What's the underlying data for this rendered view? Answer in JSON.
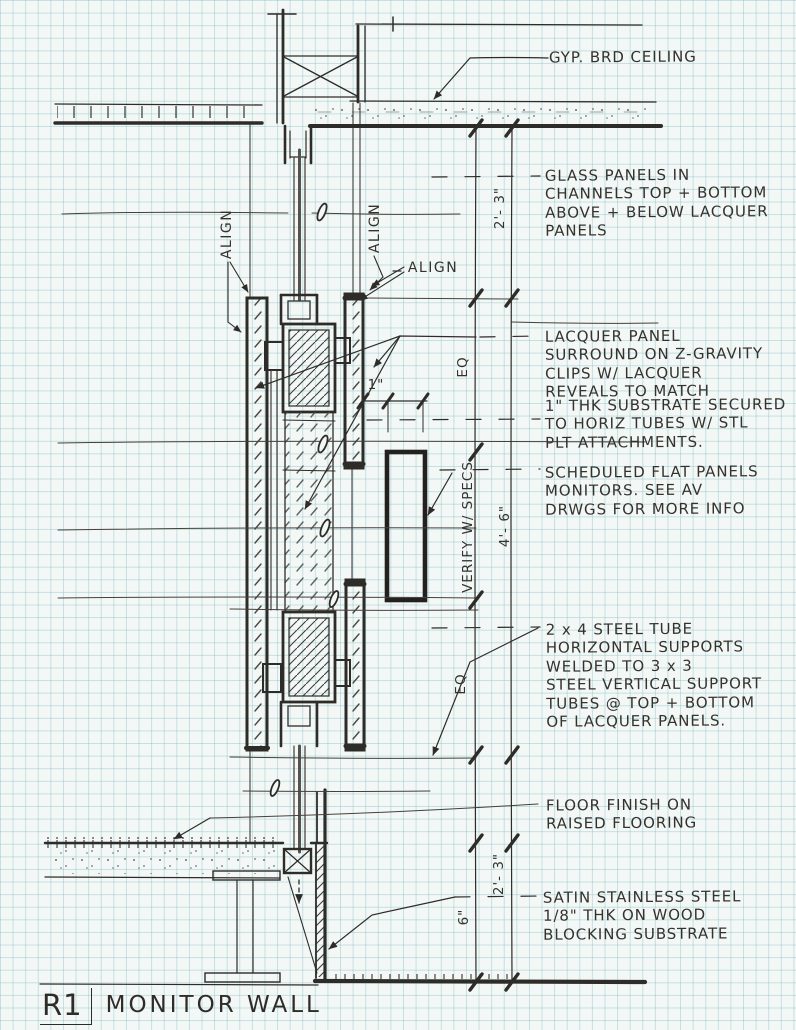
{
  "title": {
    "ref": "R1",
    "name": "MONITOR WALL"
  },
  "annotations": {
    "gyp": {
      "lines": [
        "GYP. BRD CEILING"
      ]
    },
    "glass": {
      "lines": [
        "GLASS PANELS IN",
        "CHANNELS TOP + BOTTOM",
        "ABOVE + BELOW LACQUER",
        "PANELS"
      ]
    },
    "lacquer": {
      "lines": [
        "LACQUER PANEL",
        "SURROUND ON Z-GRAVITY",
        "CLIPS W/ LACQUER",
        "REVEALS TO MATCH"
      ]
    },
    "substrate": {
      "lines": [
        "1\" THK SUBSTRATE SECURED",
        "TO HORIZ TUBES W/ STL",
        "PLT ATTACHMENTS."
      ]
    },
    "monitors": {
      "lines": [
        "SCHEDULED FLAT PANELS",
        "MONITORS. SEE AV",
        "DRWGS FOR MORE INFO"
      ]
    },
    "steel": {
      "lines": [
        "2 x 4 STEEL TUBE",
        "HORIZONTAL SUPPORTS",
        "WELDED TO  3 x 3",
        "STEEL VERTICAL SUPPORT",
        "TUBES @ TOP + BOTTOM",
        "OF LACQUER PANELS."
      ]
    },
    "floor": {
      "lines": [
        "FLOOR FINISH ON",
        "RAISED FLOORING"
      ]
    },
    "stainless": {
      "lines": [
        "SATIN STAINLESS STEEL",
        "1/8\" THK ON  WOOD",
        "BLOCKING SUBSTRATE"
      ]
    }
  },
  "dimensions": {
    "top_segment": "2'- 3\"",
    "eq_upper": "EQ",
    "substrate_thickness": "1\"",
    "monitor_height": "4'- 6\"",
    "verify": "VERIFY W/ SPECS",
    "eq_lower": "EQ",
    "bottom_segment": "2'- 3\"",
    "raised_floor": "6\""
  },
  "align": {
    "left": "ALIGN",
    "right": "ALIGN",
    "callout": "ALIGN"
  },
  "colors": {
    "ink": "#2e2c29",
    "paper": "#f3f7f5",
    "grid_line": "#c2dcdd",
    "glass_core": "#55524e"
  }
}
